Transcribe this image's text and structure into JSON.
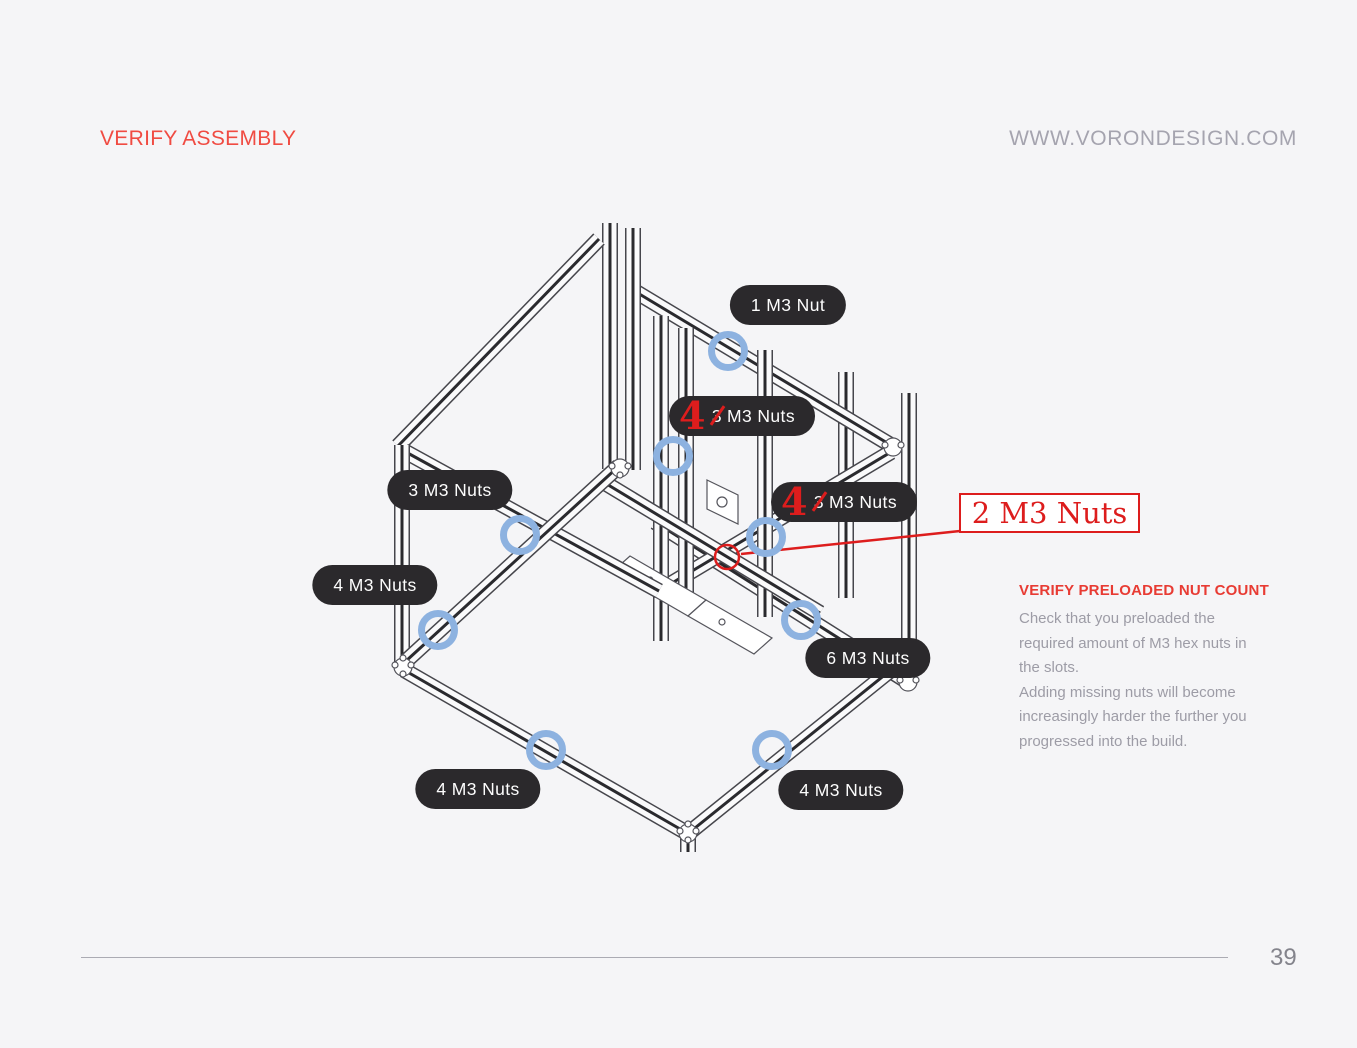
{
  "header": {
    "title": "VERIFY ASSEMBLY",
    "website": "WWW.VORONDESIGN.COM"
  },
  "diagram": {
    "callouts": [
      {
        "label": "1 M3 Nut"
      },
      {
        "original_count": "3",
        "label_rest": "M3 Nuts",
        "corrected_count": "4"
      },
      {
        "label": "3 M3 Nuts"
      },
      {
        "original_count": "3",
        "label_rest": "M3 Nuts",
        "corrected_count": "4"
      },
      {
        "label": "4 M3 Nuts"
      },
      {
        "label": "6 M3 Nuts"
      },
      {
        "label": "4 M3 Nuts"
      },
      {
        "label": "4 M3 Nuts"
      }
    ],
    "correction_box": {
      "label": "2 M3 Nuts"
    },
    "nut_marker_count": 8
  },
  "note": {
    "heading": "VERIFY PRELOADED NUT COUNT",
    "paragraph1": "Check that you preloaded the required amount of M3 hex nuts in the slots.",
    "paragraph2": "Adding missing nuts will become increasingly harder the further you progressed into the build."
  },
  "footer": {
    "page_number": "39"
  },
  "colors": {
    "background": "#f5f5f7",
    "accent_red": "#f04b42",
    "annotation_red": "#dd1d1d",
    "pill_background": "#2b292c",
    "marker_blue": "#8db2e0",
    "muted_text": "#9d9ca6"
  }
}
